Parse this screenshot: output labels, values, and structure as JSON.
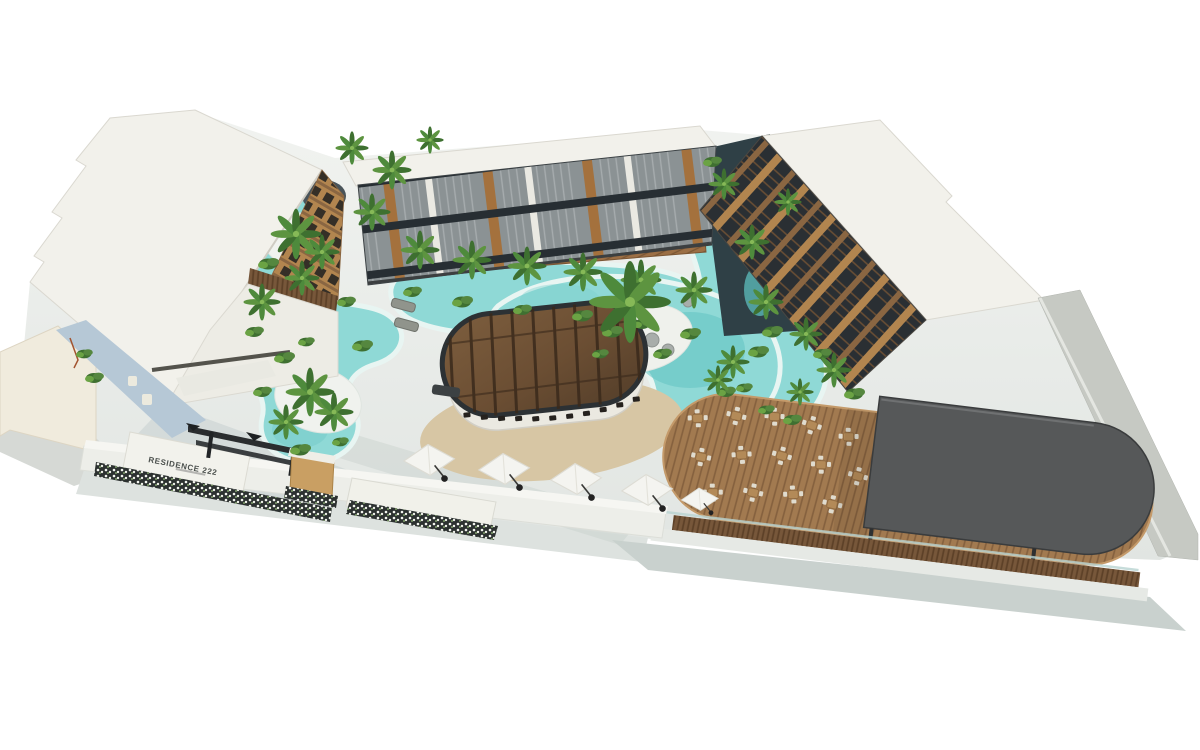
{
  "scene": {
    "type": "3D architectural aerial rendering",
    "subject": "Tropical resort residence complex with lagoon-style pool, central glass-roof pavilion bar, palm landscaping and rooftop-view dining deck",
    "background": "white",
    "sign": {
      "text": "RESIDENCE 222"
    }
  },
  "palette": {
    "pool_water": "#8fd9d6",
    "pool_deep": "#63c2c2",
    "pool_rim": "#e8f5f2",
    "sand": "#d7c6a4",
    "roof_white": "#f2f1eb",
    "facade_wood": "#b2854f",
    "glass_dark": "#2a3136",
    "canopy_gray": "#565859",
    "deck_wood": "#a27a50",
    "boardwalk_wood": "#9c6f45",
    "foliage_green": "#4e8a3c",
    "concrete_ground": "#e8eae7",
    "planter_dark": "#2c3130"
  },
  "features": [
    "left residential building with wood balconies",
    "central residential building with louvered balconies",
    "right residential building with wood balconies",
    "winding lagoon swimming pool",
    "palm tree islands",
    "oval glass-roof swim-up pavilion bar",
    "bar stools",
    "sand lounge ellipse",
    "white cantilever umbrellas",
    "wooden restaurant deck with dining tables",
    "dark flat canopy roof",
    "entrance sign wall with flower planters",
    "entrance pergola beams",
    "perimeter concrete wall"
  ]
}
